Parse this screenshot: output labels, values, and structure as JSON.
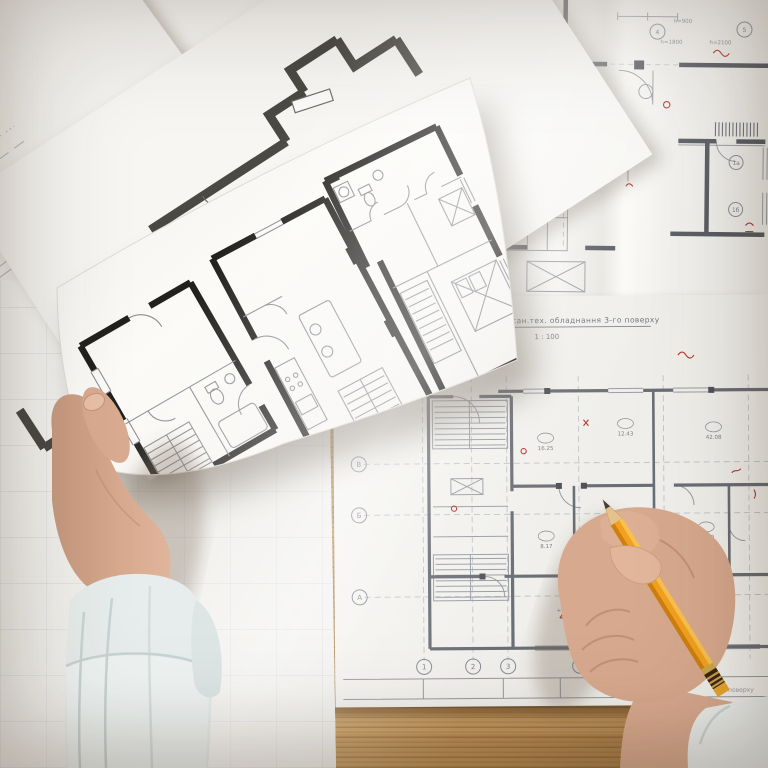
{
  "blueprint_lower": {
    "title": "План розміщення сан.тех. обладнання 3-го поверху",
    "scale": "1 : 100",
    "row_bubbles": [
      "В",
      "Б",
      "А"
    ],
    "col_bubbles": [
      "1",
      "2",
      "3",
      "4"
    ],
    "room_areas": [
      "16.25",
      "12.43",
      "8.17",
      "18.59",
      "42.08",
      "+4.750"
    ],
    "corner_note": "3-го поверху"
  },
  "blueprint_upper": {
    "notes": [
      "h=900",
      "h=1800",
      "h=2100"
    ],
    "tags": [
      "4",
      "5",
      "1а",
      "1б"
    ]
  },
  "colors": {
    "wood": "#b5894f",
    "paper": "#f6f5f2",
    "blueprint_line": "#7c8187",
    "bold_wall": "#21201d",
    "red_mark": "#b5362b",
    "pencil_body": "#efa01e",
    "skin": "#d5a78d",
    "sleeve": "#e6ebea"
  }
}
